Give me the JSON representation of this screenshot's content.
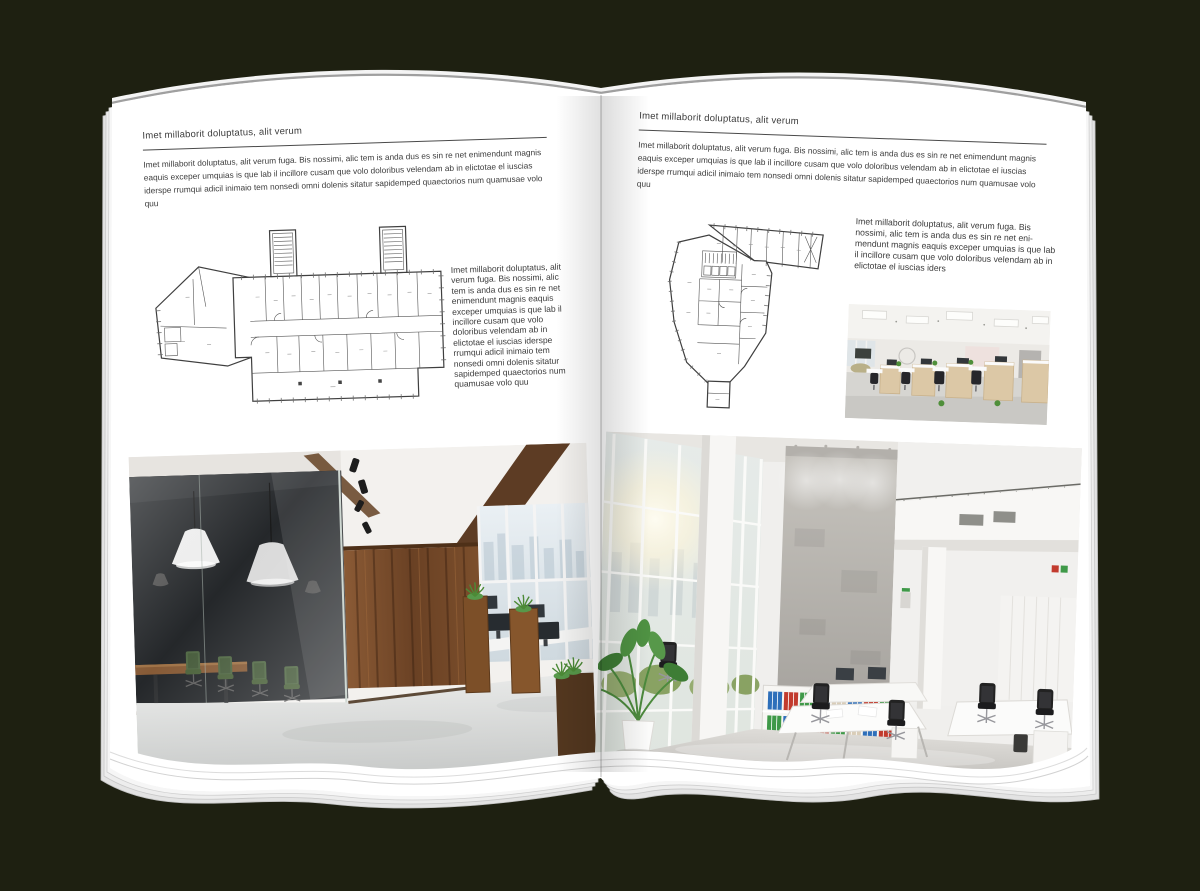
{
  "book": {
    "background_color": "#1e2011",
    "paper_color": "#ffffff"
  },
  "colors": {
    "wood_accent": "#7a4e2a",
    "plant_green": "#4f8f3a",
    "binder_blue": "#2e6fba",
    "binder_red": "#c23b2e",
    "binder_green": "#3f9948"
  },
  "left_page": {
    "header": "Imet millaborit doluptatus, alit verum",
    "intro": "Imet millaborit doluptatus, alit verum fuga. Bis nossimi, alic tem is anda dus es sin re net enimendunt magnis eaquis exceper umquias is que lab il incillore cusam que volo doloribus velendam ab in elictotae el iuscias iderspe rrumqui adicil inimaio tem nonsedi omni dolenis sitatur sapidemped quaectorios num quamusae volo quu",
    "side_text": "Imet millaborit doluptatus, alit verum fuga. Bis nossimi, alic tem is anda dus es sin re net enimendunt magnis eaquis exceper umquias is que lab il incillore cusam que volo doloribus velendam ab in elictotae el iuscias iderspe rrumqui adicil inimaio tem nonsedi omni dolenis sitatur sapidemped quaectorios num quamusae volo quu",
    "floorplan_alt": "floor plan of elongated office building with two stair cores and angled west wing",
    "photo_alt": "loft office interior with dark glass meeting room, timber feature wall and workstations"
  },
  "right_page": {
    "header": "Imet millaborit doluptatus, alit verum",
    "intro": "Imet millaborit doluptatus, alit verum fuga. Bis nossimi, alic tem is anda dus es sin re net enimendunt magnis eaquis exceper umquias is que lab il incillore cusam que volo doloribus velendam ab in elictotae el iuscias iderspe rrumqui adicil inimaio tem nonsedi omni dolenis sitatur sapidemped quaectorios num quamusae volo quu",
    "side_text": "Imet millaborit doluptatus, alit verum fuga. Bis nossimi, alic tem is anda dus es sin re net eni-mendunt magnis eaquis exceper umquias is que lab il incillore cusam que volo doloribus velendam ab in elictotae el iuscias iders",
    "floorplan_alt": "floor plan of irregular tower footprint with north-east wing",
    "small_photo_alt": "open-plan office with timber workstation pods and black chairs",
    "photo_alt": "double-height white office atrium with glazed facade, concrete wall and white desks"
  }
}
